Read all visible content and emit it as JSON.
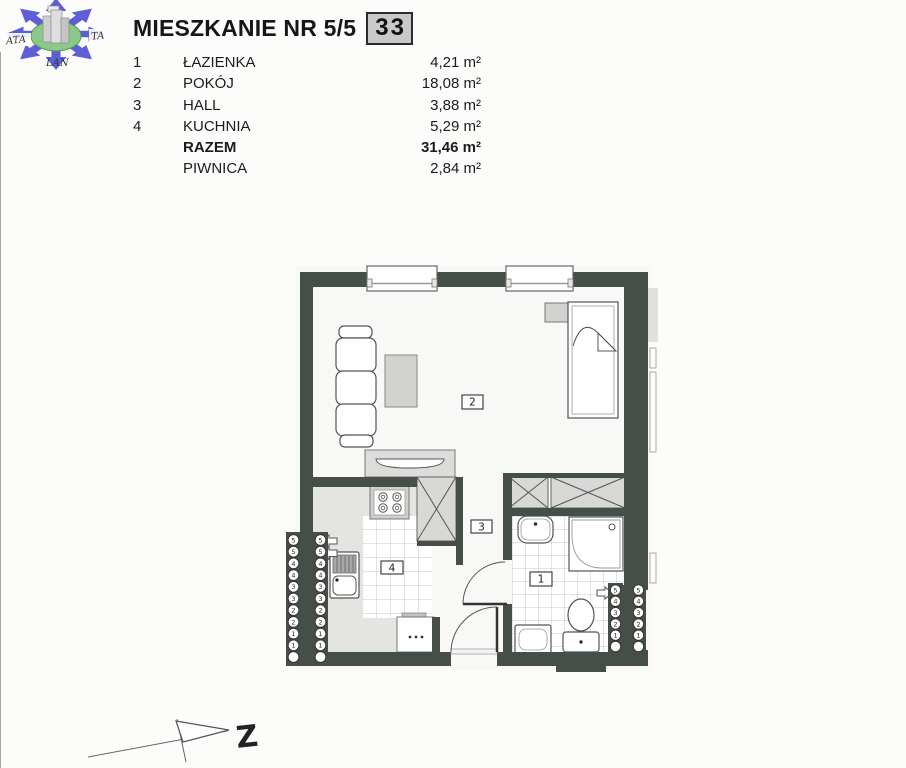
{
  "page": {
    "background": "#fcfcfb"
  },
  "logo": {
    "text_left": "ATA",
    "text_right": "TA",
    "text_bottom": "LAN",
    "arrow_color": "#5c5fd6",
    "ellipse_color": "#8cc88c"
  },
  "header": {
    "title": "MIESZKANIE NR 5/5",
    "unit_number": "33",
    "badge_bg": "#c9c9c9"
  },
  "room_table": {
    "rows": [
      {
        "no": "1",
        "name": "ŁAZIENKA",
        "area": "4,21 m²"
      },
      {
        "no": "2",
        "name": "POKÓJ",
        "area": "18,08 m²"
      },
      {
        "no": "3",
        "name": "HALL",
        "area": "3,88 m²"
      },
      {
        "no": "4",
        "name": "KUCHNIA",
        "area": "5,29 m²"
      },
      {
        "no": "",
        "name": "RAZEM",
        "area": "31,46 m²"
      },
      {
        "no": "",
        "name": "PIWNICA",
        "area": "2,84 m²"
      }
    ]
  },
  "floor_plan": {
    "wall_color": "#464f47",
    "labels": {
      "lazienka": "1",
      "pokoj": "2",
      "hall": "3",
      "kuchnia": "4"
    },
    "radiators": {
      "left": [
        "5",
        "5",
        "4",
        "4",
        "3",
        "3",
        "2",
        "2",
        "1",
        "1",
        ""
      ],
      "right": [
        "5",
        "4",
        "3",
        "2",
        "1",
        ""
      ]
    }
  },
  "north_arrow": {
    "label": "Z"
  }
}
